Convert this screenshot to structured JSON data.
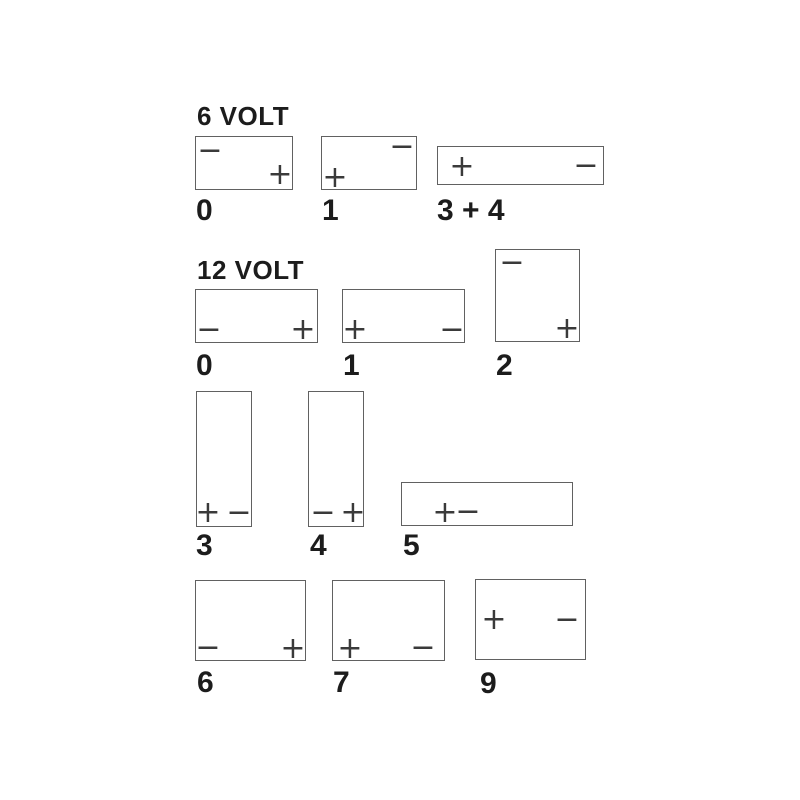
{
  "canvas": {
    "width": 800,
    "height": 800,
    "background": "#ffffff"
  },
  "style": {
    "box_border_color": "#616161",
    "terminal_color": "#3a3a3a",
    "text_color": "#1c1c1c"
  },
  "diagram_type": "battery-terminal-layouts",
  "sections": [
    {
      "title": "6 VOLT",
      "title_pos": {
        "x": 197,
        "y": 103
      },
      "boxes": [
        {
          "id": "6v-0",
          "label": "0",
          "rect": {
            "x": 195,
            "y": 136,
            "w": 98,
            "h": 54
          },
          "label_pos": {
            "x": 196,
            "y": 196
          },
          "terminals": [
            {
              "type": "minus",
              "glyph": "−",
              "x": 14,
              "y": 14
            },
            {
              "type": "plus",
              "glyph": "+",
              "x": 84,
              "y": 38
            }
          ]
        },
        {
          "id": "6v-1",
          "label": "1",
          "rect": {
            "x": 321,
            "y": 136,
            "w": 96,
            "h": 54
          },
          "label_pos": {
            "x": 322,
            "y": 196
          },
          "terminals": [
            {
              "type": "minus",
              "glyph": "−",
              "x": 80,
              "y": 10
            },
            {
              "type": "plus",
              "glyph": "+",
              "x": 13,
              "y": 41
            }
          ]
        },
        {
          "id": "6v-3-4",
          "label": "3 + 4",
          "rect": {
            "x": 437,
            "y": 146,
            "w": 167,
            "h": 39
          },
          "label_pos": {
            "x": 437,
            "y": 196
          },
          "terminals": [
            {
              "type": "plus",
              "glyph": "+",
              "x": 24,
              "y": 20
            },
            {
              "type": "minus",
              "glyph": "−",
              "x": 148,
              "y": 19
            }
          ]
        }
      ]
    },
    {
      "title": "12 VOLT",
      "title_pos": {
        "x": 197,
        "y": 257
      },
      "boxes": [
        {
          "id": "12v-0",
          "label": "0",
          "rect": {
            "x": 195,
            "y": 289,
            "w": 123,
            "h": 54
          },
          "label_pos": {
            "x": 196,
            "y": 351
          },
          "terminals": [
            {
              "type": "minus",
              "glyph": "−",
              "x": 13,
              "y": 40
            },
            {
              "type": "plus",
              "glyph": "+",
              "x": 107,
              "y": 40
            }
          ]
        },
        {
          "id": "12v-1",
          "label": "1",
          "rect": {
            "x": 342,
            "y": 289,
            "w": 123,
            "h": 54
          },
          "label_pos": {
            "x": 343,
            "y": 351
          },
          "terminals": [
            {
              "type": "plus",
              "glyph": "+",
              "x": 12,
              "y": 40
            },
            {
              "type": "minus",
              "glyph": "−",
              "x": 109,
              "y": 40
            }
          ]
        },
        {
          "id": "12v-2",
          "label": "2",
          "rect": {
            "x": 495,
            "y": 249,
            "w": 85,
            "h": 93
          },
          "label_pos": {
            "x": 496,
            "y": 351
          },
          "terminals": [
            {
              "type": "minus",
              "glyph": "−",
              "x": 16,
              "y": 13
            },
            {
              "type": "plus",
              "glyph": "+",
              "x": 71,
              "y": 79
            }
          ]
        },
        {
          "id": "12v-3",
          "label": "3",
          "rect": {
            "x": 196,
            "y": 391,
            "w": 56,
            "h": 136
          },
          "label_pos": {
            "x": 196,
            "y": 531
          },
          "terminals": [
            {
              "type": "plus",
              "glyph": "+",
              "x": 11,
              "y": 121
            },
            {
              "type": "minus",
              "glyph": "−",
              "x": 42,
              "y": 121
            }
          ]
        },
        {
          "id": "12v-4",
          "label": "4",
          "rect": {
            "x": 308,
            "y": 391,
            "w": 56,
            "h": 136
          },
          "label_pos": {
            "x": 310,
            "y": 531
          },
          "terminals": [
            {
              "type": "minus",
              "glyph": "−",
              "x": 14,
              "y": 121
            },
            {
              "type": "plus",
              "glyph": "+",
              "x": 44,
              "y": 121
            }
          ]
        },
        {
          "id": "12v-5",
          "label": "5",
          "rect": {
            "x": 401,
            "y": 482,
            "w": 172,
            "h": 44
          },
          "label_pos": {
            "x": 403,
            "y": 531
          },
          "terminals": [
            {
              "type": "plus",
              "glyph": "+",
              "x": 43,
              "y": 30
            },
            {
              "type": "minus",
              "glyph": "−",
              "x": 66,
              "y": 29
            }
          ]
        },
        {
          "id": "12v-6",
          "label": "6",
          "rect": {
            "x": 195,
            "y": 580,
            "w": 111,
            "h": 81
          },
          "label_pos": {
            "x": 197,
            "y": 668
          },
          "terminals": [
            {
              "type": "minus",
              "glyph": "−",
              "x": 12,
              "y": 67
            },
            {
              "type": "plus",
              "glyph": "+",
              "x": 97,
              "y": 68
            }
          ]
        },
        {
          "id": "12v-7",
          "label": "7",
          "rect": {
            "x": 332,
            "y": 580,
            "w": 113,
            "h": 81
          },
          "label_pos": {
            "x": 333,
            "y": 668
          },
          "terminals": [
            {
              "type": "plus",
              "glyph": "+",
              "x": 17,
              "y": 68
            },
            {
              "type": "minus",
              "glyph": "−",
              "x": 90,
              "y": 67
            }
          ]
        },
        {
          "id": "12v-9",
          "label": "9",
          "rect": {
            "x": 475,
            "y": 579,
            "w": 111,
            "h": 81
          },
          "label_pos": {
            "x": 480,
            "y": 669
          },
          "terminals": [
            {
              "type": "plus",
              "glyph": "+",
              "x": 18,
              "y": 40
            },
            {
              "type": "minus",
              "glyph": "−",
              "x": 91,
              "y": 40
            }
          ]
        }
      ]
    }
  ]
}
